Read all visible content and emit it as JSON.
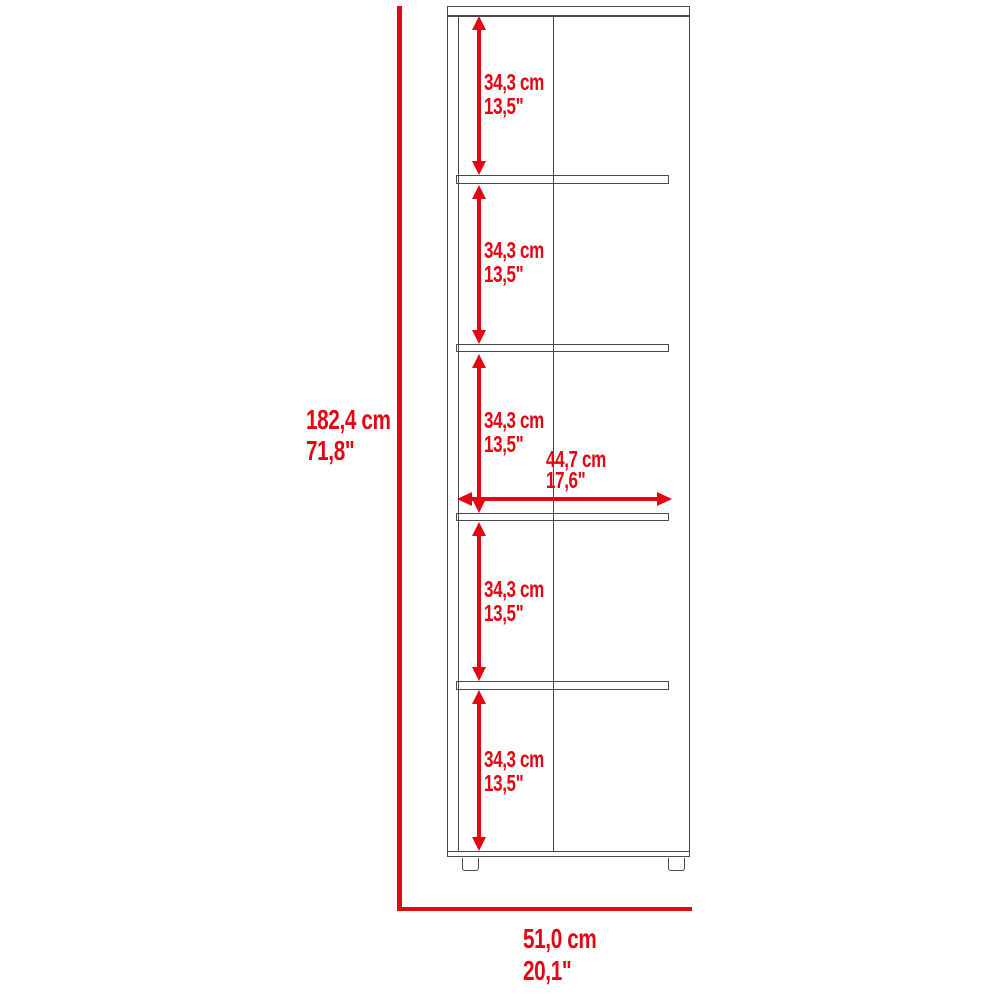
{
  "diagram": {
    "type": "furniture-dimension-drawing",
    "colors": {
      "dimension_red": "#e30613",
      "line_gray": "#4a4a4a",
      "background": "#ffffff"
    },
    "overall_height": {
      "cm": "182,4 cm",
      "inches": "71,8\""
    },
    "overall_width": {
      "cm": "51,0 cm",
      "inches": "20,1\""
    },
    "interior_width": {
      "cm": "44,7 cm",
      "inches": "17,6\""
    },
    "sections": [
      {
        "cm": "34,3 cm",
        "inches": "13,5\""
      },
      {
        "cm": "34,3 cm",
        "inches": "13,5\""
      },
      {
        "cm": "34,3 cm",
        "inches": "13,5\""
      },
      {
        "cm": "34,3 cm",
        "inches": "13,5\""
      },
      {
        "cm": "34,3 cm",
        "inches": "13,5\""
      }
    ]
  }
}
